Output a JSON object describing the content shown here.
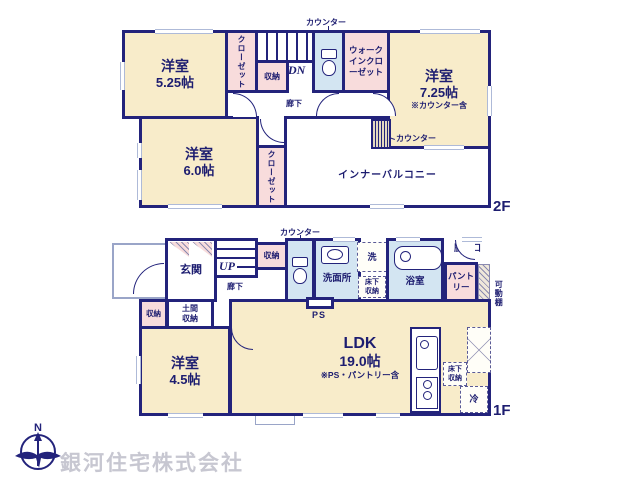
{
  "colors": {
    "wall": "#23237b",
    "room_cream": "#f8ecca",
    "closet_pink": "#f8dcdc",
    "wet_blue": "#d3e5f2",
    "window": "#aebad8",
    "watermark": "#c7c7d1"
  },
  "floor2": {
    "floor_label": "2F",
    "room525": {
      "name": "洋室",
      "size": "5.25帖"
    },
    "room725": {
      "name": "洋室",
      "size": "7.25帖",
      "note": "※カウンター含"
    },
    "room60": {
      "name": "洋室",
      "size": "6.0帖"
    },
    "closet1": "クローゼット",
    "closet2": "クローゼット",
    "wic": "ウォークインクローゼット",
    "storage": "収納",
    "stairs_label": "DN",
    "hallway": "廊下",
    "balcony": "インナーバルコニー",
    "counter_top": "カウンター",
    "counter_side": "カウンター"
  },
  "floor1": {
    "floor_label": "1F",
    "entrance": "玄関",
    "stairs_label": "UP",
    "hallway": "廊下",
    "storage_hall": "収納",
    "counter_top": "カウンター",
    "washroom": "洗面所",
    "laundry": "洗",
    "underfloor_wash": "床下収納",
    "bath": "浴室",
    "backdoor": "勝手口",
    "pantry": "パントリー",
    "shelf_right": "可動棚",
    "storage_entry": "収納",
    "doma": "土間収納",
    "shelf_room": "可動棚",
    "room45": {
      "name": "洋室",
      "size": "4.5帖"
    },
    "ldk": {
      "name": "LDK",
      "size": "19.0帖",
      "note": "※PS・パントリー含"
    },
    "ps": "PS",
    "underfloor_kitchen": "床下収納",
    "fridge": "冷"
  },
  "footer": {
    "company": "銀河住宅株式会社",
    "compass_north": "N"
  }
}
